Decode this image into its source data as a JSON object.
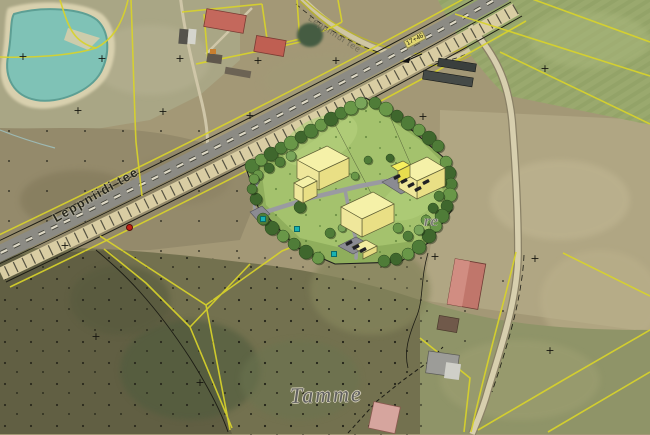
{
  "labels": {
    "road_main": "Leppniidi tee",
    "road_secondary": "Leppniidi tee",
    "place": "Tamme",
    "place_fragment": "re",
    "station_marker": "17+46"
  },
  "colors": {
    "cadastral_line": "#d8d32a",
    "water": "#7fc2b6",
    "sand": "#d8d0ae",
    "asphalt": "#8c8b84",
    "road_shoulder": "#d9cda3",
    "site_lawn": "#8fae5c",
    "site_lawn_light": "#a6c46f",
    "building_roof": "#f5f1a8",
    "building_wall_dark": "#e9df85",
    "building_wall_light": "#efe79b",
    "annex_roof": "#f6ef5e",
    "annex_wall": "#e8dd4e",
    "small_roof": "#f2eda0",
    "small_wall": "#e6db82",
    "parking": "#8b8b92",
    "car": "#202024",
    "marker_red": "#c32014",
    "marker_teal": "#18b2b2",
    "label_gray": "#666666"
  },
  "map": {
    "cross_glyph": "+",
    "survey_crosses": [
      [
        23,
        58
      ],
      [
        102,
        60
      ],
      [
        180,
        60
      ],
      [
        78,
        112
      ],
      [
        163,
        113
      ],
      [
        250,
        117
      ],
      [
        258,
        62
      ],
      [
        336,
        62
      ],
      [
        423,
        118
      ],
      [
        435,
        258
      ],
      [
        535,
        260
      ],
      [
        550,
        352
      ],
      [
        96,
        338
      ],
      [
        65,
        247
      ],
      [
        200,
        384
      ],
      [
        545,
        70
      ]
    ],
    "utility_markers": [
      [
        296,
        228
      ],
      [
        333,
        253
      ],
      [
        262,
        218
      ]
    ]
  },
  "site_plan": {
    "tree_colors": [
      "#4f7c38",
      "#699748",
      "#3f672d",
      "#7aa55a"
    ],
    "trees": [
      [
        252,
        166,
        7,
        0
      ],
      [
        261,
        160,
        6,
        1
      ],
      [
        271,
        154,
        7,
        2
      ],
      [
        281,
        148,
        6,
        0
      ],
      [
        291,
        143,
        7,
        1
      ],
      [
        301,
        137,
        6,
        2
      ],
      [
        311,
        131,
        7,
        0
      ],
      [
        321,
        125,
        6,
        1
      ],
      [
        331,
        119,
        7,
        2
      ],
      [
        341,
        113,
        6,
        0
      ],
      [
        351,
        108,
        7,
        1
      ],
      [
        361,
        103,
        6,
        3
      ],
      [
        258,
        175,
        5,
        1
      ],
      [
        269,
        168,
        5,
        2
      ],
      [
        280,
        162,
        5,
        0
      ],
      [
        291,
        156,
        5,
        3
      ],
      [
        375,
        103,
        6,
        0
      ],
      [
        386,
        109,
        7,
        1
      ],
      [
        397,
        116,
        6,
        2
      ],
      [
        408,
        123,
        7,
        0
      ],
      [
        419,
        130,
        6,
        1
      ],
      [
        429,
        138,
        7,
        2
      ],
      [
        438,
        146,
        6,
        0
      ],
      [
        446,
        162,
        6,
        1
      ],
      [
        449,
        173,
        7,
        2
      ],
      [
        451,
        184,
        6,
        0
      ],
      [
        450,
        195,
        7,
        1
      ],
      [
        447,
        206,
        6,
        2
      ],
      [
        442,
        216,
        7,
        0
      ],
      [
        436,
        226,
        6,
        1
      ],
      [
        429,
        236,
        7,
        2
      ],
      [
        438,
        170,
        5,
        3
      ],
      [
        441,
        182,
        5,
        1
      ],
      [
        439,
        196,
        5,
        0
      ],
      [
        433,
        208,
        5,
        2
      ],
      [
        426,
        220,
        5,
        1
      ],
      [
        419,
        230,
        5,
        3
      ],
      [
        419,
        247,
        7,
        0
      ],
      [
        408,
        254,
        6,
        1
      ],
      [
        396,
        259,
        6,
        2
      ],
      [
        384,
        261,
        6,
        0
      ],
      [
        318,
        258,
        6,
        1
      ],
      [
        306,
        252,
        7,
        2
      ],
      [
        294,
        244,
        6,
        0
      ],
      [
        283,
        236,
        6,
        1
      ],
      [
        272,
        228,
        7,
        2
      ],
      [
        263,
        219,
        6,
        0
      ],
      [
        256,
        199,
        6,
        2
      ],
      [
        252,
        189,
        5,
        0
      ],
      [
        254,
        179,
        5,
        1
      ],
      [
        300,
        207,
        6,
        2
      ],
      [
        368,
        160,
        4,
        0
      ],
      [
        355,
        176,
        4,
        1
      ],
      [
        390,
        158,
        4,
        2
      ],
      [
        330,
        233,
        5,
        0
      ],
      [
        342,
        228,
        4,
        3
      ],
      [
        398,
        228,
        5,
        1
      ],
      [
        408,
        236,
        5,
        0
      ]
    ],
    "buildings": [
      {
        "name": "building-a-main",
        "faces": [
          {
            "p": "297,160 327,146 349,158 319,172",
            "f": "building_roof"
          },
          {
            "p": "319,172 349,158 349,176 319,190",
            "f": "building_wall_dark"
          },
          {
            "p": "297,160 319,172 319,190 297,178",
            "f": "building_wall_light"
          }
        ]
      },
      {
        "name": "building-a-annex",
        "faces": [
          {
            "p": "294,183 308,176 317,181 303,188",
            "f": "building_roof"
          },
          {
            "p": "303,188 317,181 317,196 303,203",
            "f": "building_wall_dark"
          },
          {
            "p": "294,183 303,188 303,203 294,198",
            "f": "building_wall_light"
          }
        ]
      },
      {
        "name": "building-b-center",
        "faces": [
          {
            "p": "341,207 373,192 394,204 362,219",
            "f": "building_roof"
          },
          {
            "p": "362,219 394,204 394,222 362,237",
            "f": "building_wall_dark"
          },
          {
            "p": "341,207 362,219 362,237 341,225",
            "f": "building_wall_light"
          }
        ]
      },
      {
        "name": "building-c-east",
        "faces": [
          {
            "p": "399,170 427,157 445,168 417,181",
            "f": "building_roof"
          },
          {
            "p": "417,181 445,168 445,186 417,199",
            "f": "building_wall_dark"
          },
          {
            "p": "399,170 417,181 417,199 399,188",
            "f": "building_wall_light"
          }
        ]
      },
      {
        "name": "building-c-annex",
        "faces": [
          {
            "p": "391,166 403,161 410,165 398,171",
            "f": "annex_roof"
          },
          {
            "p": "398,171 410,165 410,177 398,183",
            "f": "annex_wall"
          }
        ]
      },
      {
        "name": "building-d-south",
        "faces": [
          {
            "p": "352,247 366,240 377,246 363,253",
            "f": "small_roof"
          },
          {
            "p": "363,253 377,246 377,252 363,259",
            "f": "small_wall"
          }
        ]
      }
    ],
    "cars": [
      [
        397,
        177,
        -27
      ],
      [
        404,
        181,
        -27
      ],
      [
        411,
        185,
        -27
      ],
      [
        418,
        189,
        -27
      ],
      [
        426,
        182,
        -27
      ],
      [
        349,
        243,
        -27
      ],
      [
        356,
        247,
        -27
      ],
      [
        363,
        250,
        -27
      ]
    ]
  }
}
